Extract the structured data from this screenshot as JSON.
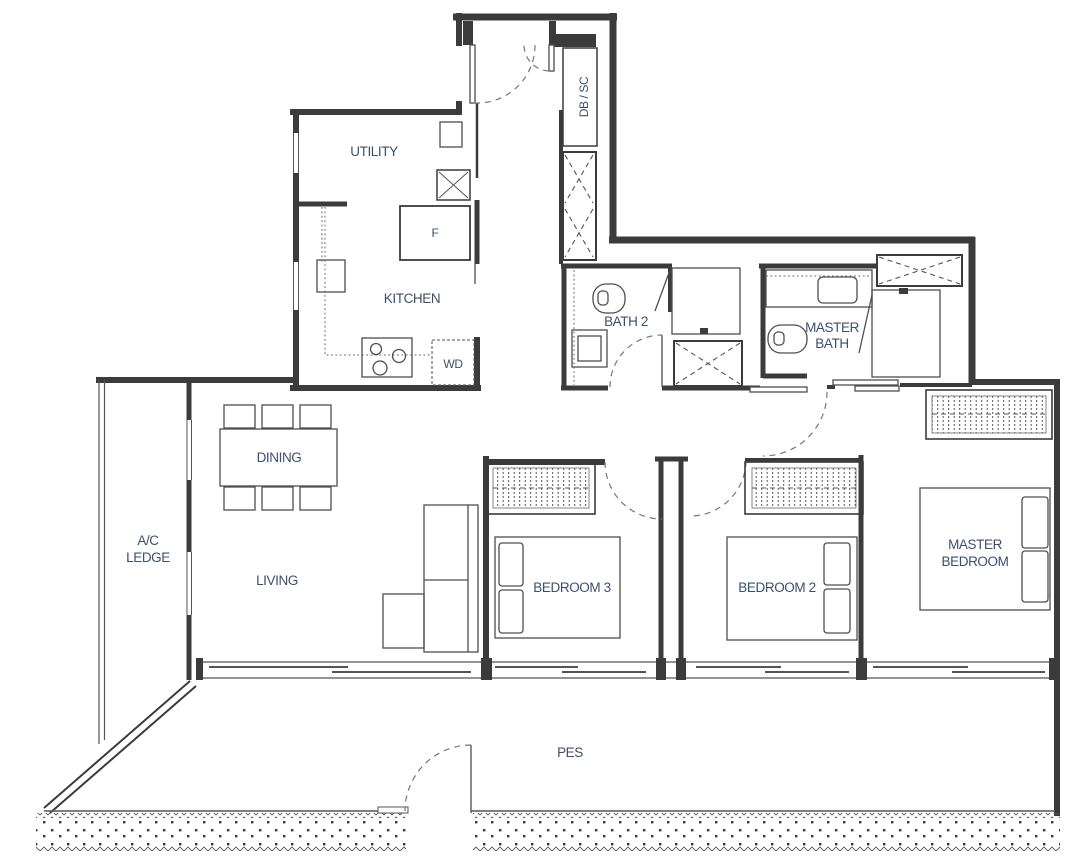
{
  "plan": {
    "type": "residential-unit-floor-plan",
    "rooms": {
      "utility": "UTILITY",
      "kitchen": "KITCHEN",
      "dining": "DINING",
      "living": "LIVING",
      "ac_ledge_1": "A/C",
      "ac_ledge_2": "LEDGE",
      "bath2": "BATH 2",
      "master_bath_1": "MASTER",
      "master_bath_2": "BATH",
      "bedroom3": "BEDROOM 3",
      "bedroom2": "BEDROOM 2",
      "master_bedroom_1": "MASTER",
      "master_bedroom_2": "BEDROOM",
      "pes": "PES",
      "db_sc": "DB / SC",
      "fridge": "F",
      "washer_dryer": "WD"
    },
    "colors": {
      "label": "#3d4f6e",
      "wall": "#3b3b3b",
      "furniture": "#4f4f4f",
      "background": "#ffffff"
    }
  }
}
